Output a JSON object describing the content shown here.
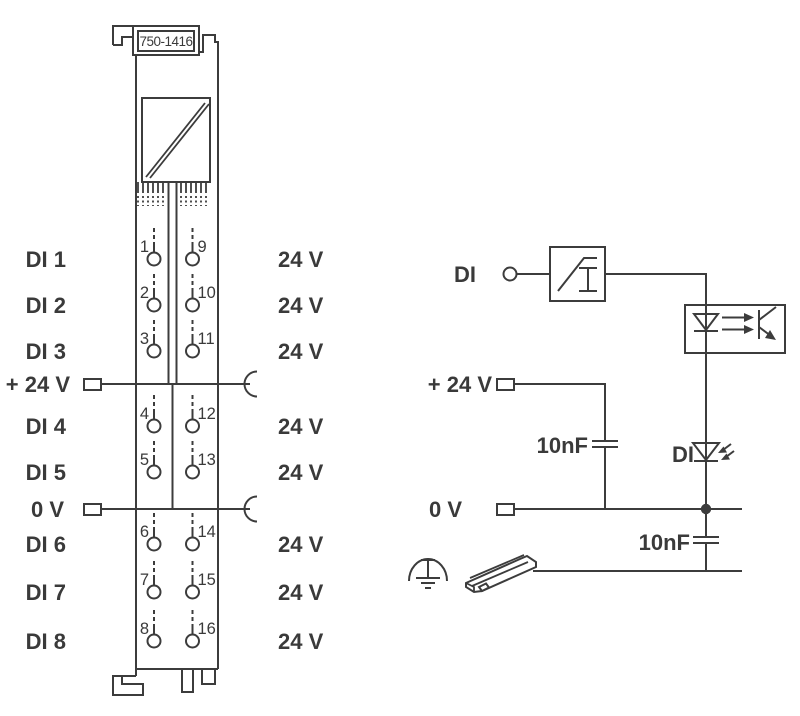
{
  "colors": {
    "line": "#3c3c3c",
    "text": "#3a3a3a",
    "background": "#ffffff"
  },
  "module": {
    "part_number": "750-1416",
    "channel_rows": [
      {
        "label": "DI 1",
        "left_terminal": "1",
        "right_terminal": "9",
        "right_label": "24 V"
      },
      {
        "label": "DI 2",
        "left_terminal": "2",
        "right_terminal": "10",
        "right_label": "24 V"
      },
      {
        "label": "DI 3",
        "left_terminal": "3",
        "right_terminal": "11",
        "right_label": "24 V"
      },
      {
        "label": "DI 4",
        "left_terminal": "4",
        "right_terminal": "12",
        "right_label": "24 V"
      },
      {
        "label": "DI 5",
        "left_terminal": "5",
        "right_terminal": "13",
        "right_label": "24 V"
      },
      {
        "label": "DI 6",
        "left_terminal": "6",
        "right_terminal": "14",
        "right_label": "24 V"
      },
      {
        "label": "DI 7",
        "left_terminal": "7",
        "right_terminal": "15",
        "right_label": "24 V"
      },
      {
        "label": "DI 8",
        "left_terminal": "8",
        "right_terminal": "16",
        "right_label": "24 V"
      }
    ],
    "power_rows": [
      {
        "label": "+ 24 V"
      },
      {
        "label": "0 V"
      }
    ]
  },
  "schematic": {
    "input_label": "DI",
    "supply_label": "+ 24 V",
    "zero_volt_label": "0 V",
    "filter_cap_label": "10nF",
    "shield_cap_label": "10nF",
    "status_led_label": "DI"
  }
}
